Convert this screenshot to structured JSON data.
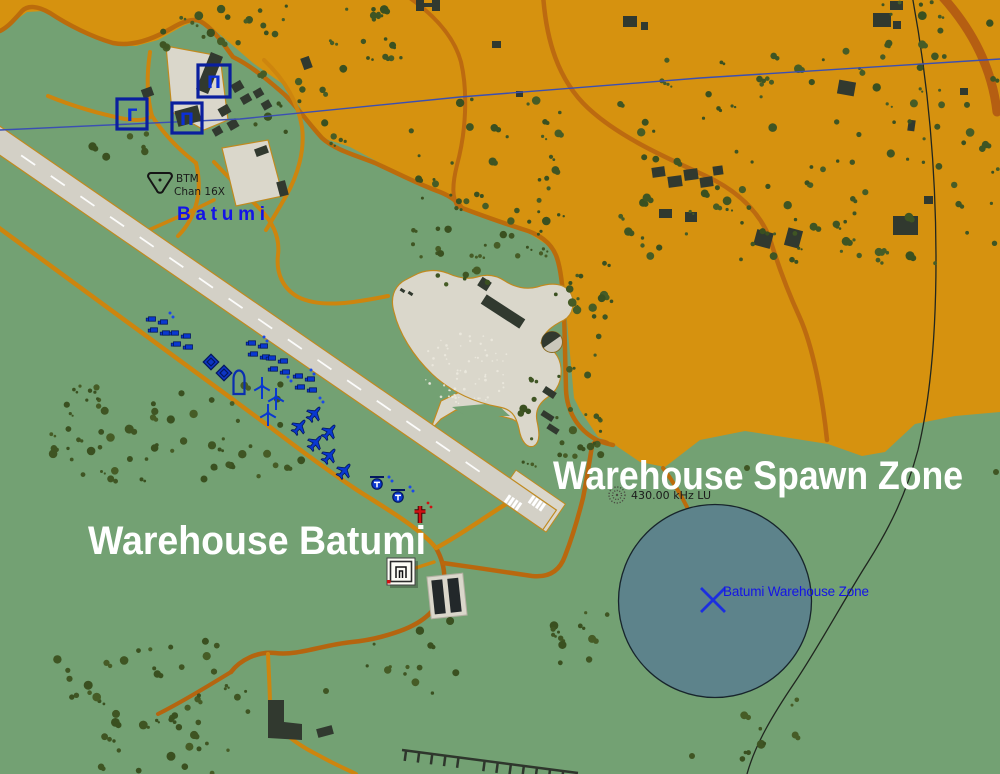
{
  "map": {
    "annotations": {
      "spawn_zone_label": "Warehouse Spawn Zone",
      "warehouse_label": "Warehouse Batumi"
    },
    "airport": {
      "name": "Batumi",
      "tacan_id": "BTM",
      "tacan_channel": "Chan 16X"
    },
    "ndb": {
      "frequency": "430.00 kHz LU"
    },
    "trigger_zone": {
      "name": "Batumi Warehouse Zone"
    },
    "static_icon_glyphs": {
      "square_gamma": "Γ",
      "square_pi_a": "П",
      "square_pi_b": "П"
    },
    "icons": [
      "tacan-beacon-icon",
      "ndb-beacon-icon",
      "warehouse-icon",
      "static-object-icon",
      "vehicle-group-icon",
      "aircraft-icon",
      "helicopter-icon",
      "wind-turbine-icon",
      "shelter-arch-icon",
      "medevac-cross-icon",
      "zone-center-cross-icon"
    ],
    "colors": {
      "terrain": "#73a173",
      "urban": "#d6920f",
      "road": "#cd850e",
      "road_dark": "#b5650f",
      "runway": "#d3d0c6",
      "apron": "#dad7cb",
      "building": "#31392f",
      "tree": "#3f5523",
      "zone_fill": "#5d828c",
      "unit_blue": "#0938d0",
      "label_blue": "#1414e6",
      "annotation_white": "#ffffff",
      "medevac_red": "#cf1212",
      "powerline_blue": "#3b4fb3"
    }
  }
}
